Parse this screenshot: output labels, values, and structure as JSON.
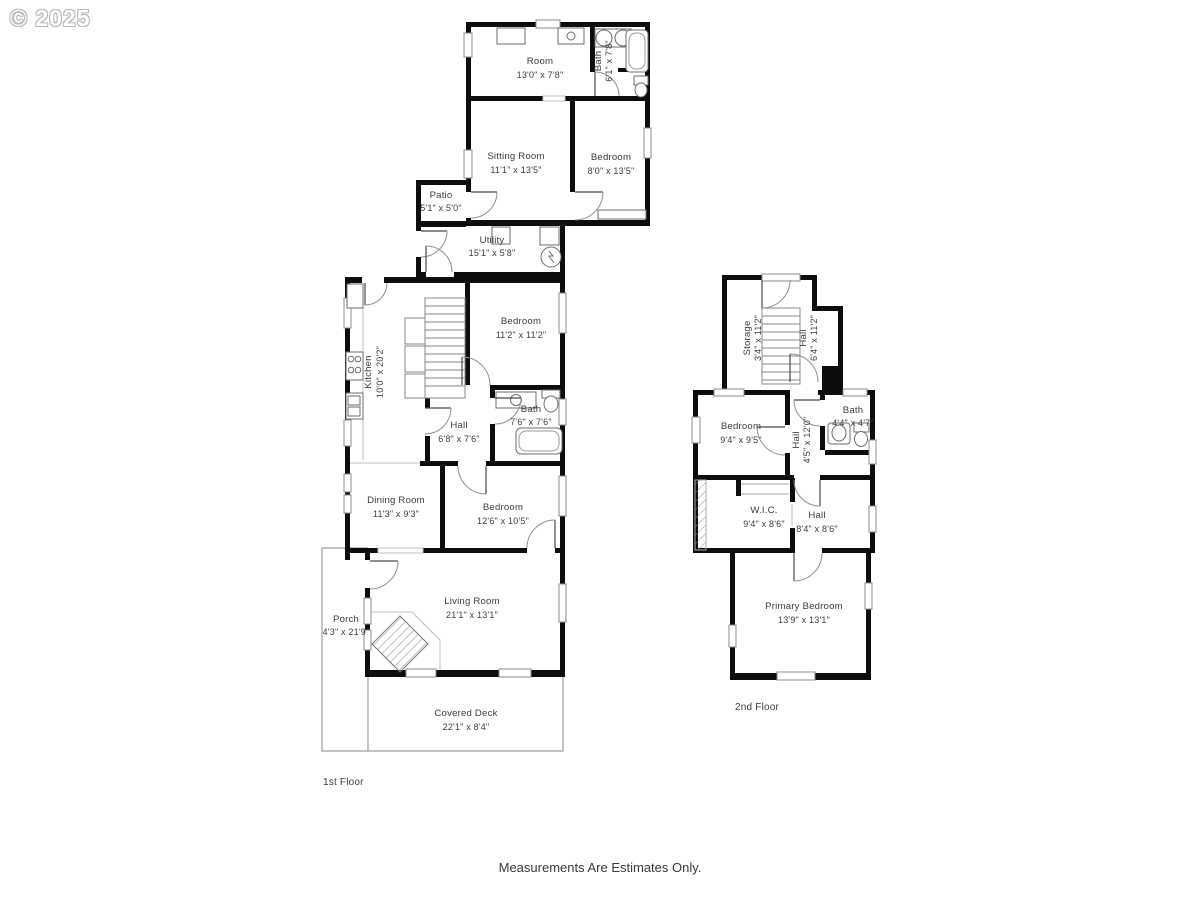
{
  "watermark": "© 2025",
  "footer_note": "Measurements Are Estimates Only.",
  "colors": {
    "wall": "#0d0d0d",
    "label_text": "#3d3d3d",
    "thin_line": "#9a9a9a",
    "background": "#ffffff"
  },
  "floor1": {
    "label": "1st Floor",
    "rooms": [
      {
        "name": "Room",
        "dims": "13'0\" x 7'8\""
      },
      {
        "name": "Bath",
        "dims": "6'1\" x 7'8\""
      },
      {
        "name": "Sitting Room",
        "dims": "11'1\" x 13'5\""
      },
      {
        "name": "Bedroom",
        "dims": "8'0\" x 13'5\""
      },
      {
        "name": "Patio",
        "dims": "5'1\" x 5'0\""
      },
      {
        "name": "Utility",
        "dims": "15'1\" x 5'8\""
      },
      {
        "name": "Kitchen",
        "dims": "10'0\" x 20'2\""
      },
      {
        "name": "Bedroom",
        "dims": "11'2\" x 11'2\""
      },
      {
        "name": "Hall",
        "dims": "6'8\" x 7'6\""
      },
      {
        "name": "Bath",
        "dims": "7'6\" x 7'6\""
      },
      {
        "name": "Dining Room",
        "dims": "11'3\" x 9'3\""
      },
      {
        "name": "Bedroom",
        "dims": "12'6\" x 10'5\""
      },
      {
        "name": "Living Room",
        "dims": "21'1\" x 13'1\""
      },
      {
        "name": "Porch",
        "dims": "4'3\" x 21'9\""
      },
      {
        "name": "Covered Deck",
        "dims": "22'1\" x 8'4\""
      }
    ]
  },
  "floor2": {
    "label": "2nd Floor",
    "rooms": [
      {
        "name": "Storage",
        "dims": "3'4\" x 11'2\""
      },
      {
        "name": "Hall",
        "dims": "6'4\" x 11'2\""
      },
      {
        "name": "Bedroom",
        "dims": "9'4\" x 9'5\""
      },
      {
        "name": "Hall",
        "dims": "4'5\" x 12'0\""
      },
      {
        "name": "Bath",
        "dims": "4'4\" x 4'7\""
      },
      {
        "name": "W.I.C.",
        "dims": "9'4\" x 8'6\""
      },
      {
        "name": "Hall",
        "dims": "8'4\" x 8'6\""
      },
      {
        "name": "Primary Bedroom",
        "dims": "13'9\" x 13'1\""
      }
    ]
  }
}
